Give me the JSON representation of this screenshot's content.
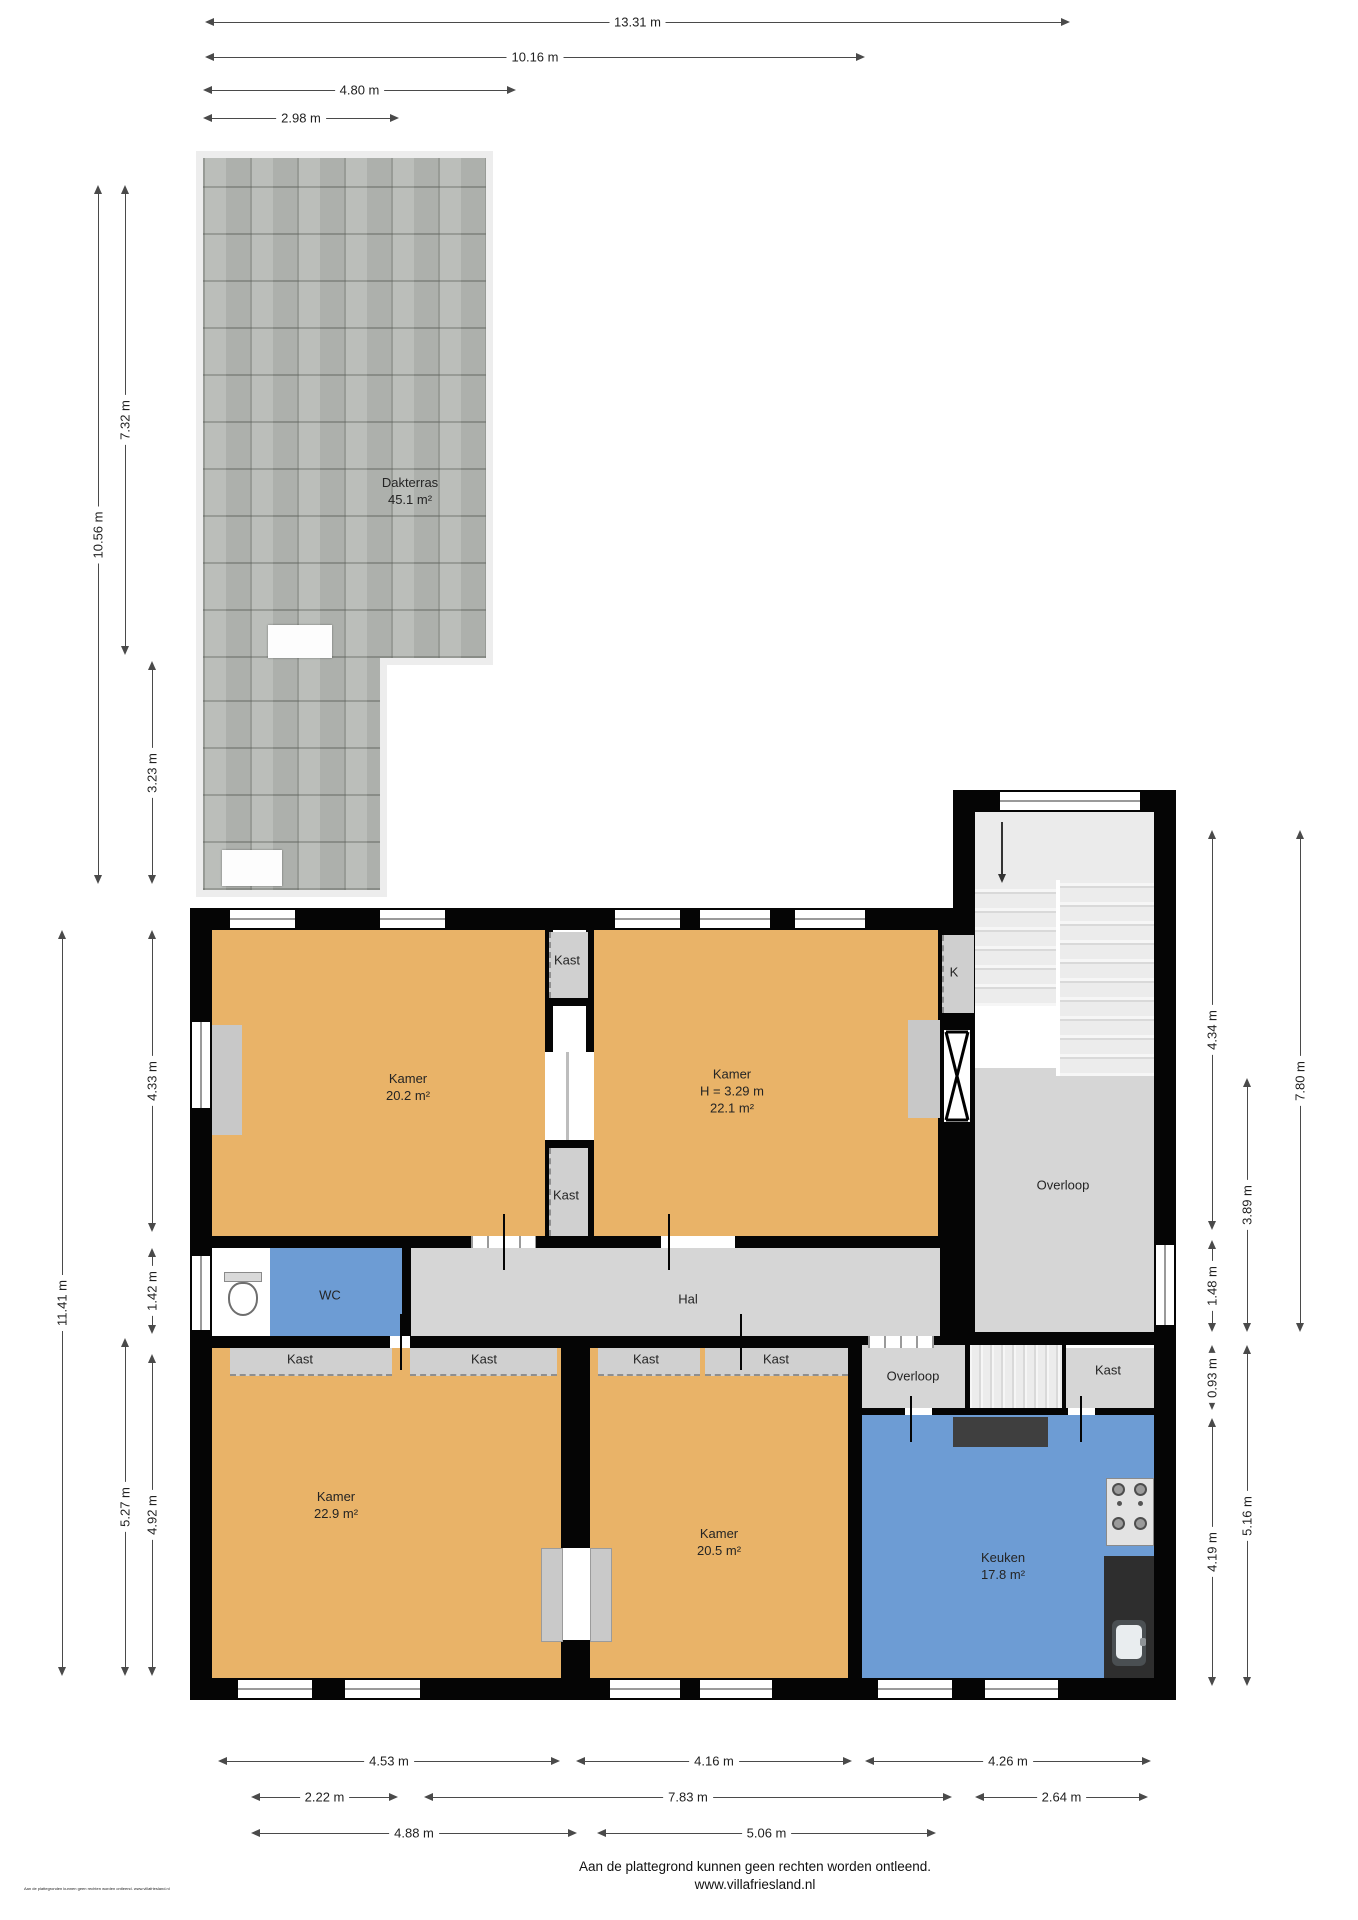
{
  "plan_title": "Plattegrond eerste verdieping",
  "colors": {
    "wall": "#050505",
    "room_orange": "#e9b368",
    "room_blue": "#6d9cd4",
    "floor_gray": "#d6d6d6",
    "terrace_tile": "#b6b9b5",
    "dimension_line": "#4a4a4a"
  },
  "rooms": [
    {
      "name": "dakterras",
      "lines": [
        "Dakterras",
        "45.1 m²"
      ],
      "x": 410,
      "y": 492
    },
    {
      "name": "kamer-20-2",
      "lines": [
        "Kamer",
        "20.2 m²"
      ],
      "x": 408,
      "y": 1088
    },
    {
      "name": "kamer-22-1",
      "lines": [
        "Kamer",
        "H = 3.29 m",
        "22.1 m²"
      ],
      "x": 732,
      "y": 1092
    },
    {
      "name": "kast-top",
      "lines": [
        "Kast"
      ],
      "x": 567,
      "y": 961
    },
    {
      "name": "kast-middle",
      "lines": [
        "Kast"
      ],
      "x": 566,
      "y": 1196
    },
    {
      "name": "kast-k",
      "lines": [
        "K"
      ],
      "x": 954,
      "y": 973
    },
    {
      "name": "overloop-boven",
      "lines": [
        "Overloop"
      ],
      "x": 1063,
      "y": 1186
    },
    {
      "name": "wc",
      "lines": [
        "WC"
      ],
      "x": 330,
      "y": 1296
    },
    {
      "name": "hal",
      "lines": [
        "Hal"
      ],
      "x": 688,
      "y": 1300
    },
    {
      "name": "kast-row-1",
      "lines": [
        "Kast"
      ],
      "x": 300,
      "y": 1360
    },
    {
      "name": "kast-row-2",
      "lines": [
        "Kast"
      ],
      "x": 484,
      "y": 1360
    },
    {
      "name": "kast-row-3",
      "lines": [
        "Kast"
      ],
      "x": 646,
      "y": 1360
    },
    {
      "name": "kast-row-4",
      "lines": [
        "Kast"
      ],
      "x": 776,
      "y": 1360
    },
    {
      "name": "overloop-onder",
      "lines": [
        "Overloop"
      ],
      "x": 913,
      "y": 1377
    },
    {
      "name": "kast-onder",
      "lines": [
        "Kast"
      ],
      "x": 1108,
      "y": 1371
    },
    {
      "name": "kamer-22-9",
      "lines": [
        "Kamer",
        "22.9 m²"
      ],
      "x": 336,
      "y": 1506
    },
    {
      "name": "kamer-20-5",
      "lines": [
        "Kamer",
        "20.5 m²"
      ],
      "x": 719,
      "y": 1543
    },
    {
      "name": "keuken",
      "lines": [
        "Keuken",
        "17.8 m²"
      ],
      "x": 1003,
      "y": 1567
    }
  ],
  "dimensions": [
    {
      "name": "dim-13-31",
      "text": "13.31 m",
      "orient": "h",
      "x1": 205,
      "x2": 1070,
      "y": 22
    },
    {
      "name": "dim-10-16",
      "text": "10.16 m",
      "orient": "h",
      "x1": 205,
      "x2": 865,
      "y": 57
    },
    {
      "name": "dim-4-80",
      "text": "4.80 m",
      "orient": "h",
      "x1": 203,
      "x2": 516,
      "y": 90
    },
    {
      "name": "dim-2-98",
      "text": "2.98 m",
      "orient": "h",
      "x1": 203,
      "x2": 399,
      "y": 118
    },
    {
      "name": "dim-10-56",
      "text": "10.56 m",
      "orient": "v",
      "x": 98,
      "y1": 185,
      "y2": 884
    },
    {
      "name": "dim-7-32",
      "text": "7.32 m",
      "orient": "v",
      "x": 125,
      "y1": 185,
      "y2": 655
    },
    {
      "name": "dim-3-23",
      "text": "3.23 m",
      "orient": "v",
      "x": 152,
      "y1": 661,
      "y2": 884
    },
    {
      "name": "dim-11-41",
      "text": "11.41 m",
      "orient": "v",
      "x": 62,
      "y1": 930,
      "y2": 1676
    },
    {
      "name": "dim-4-33",
      "text": "4.33 m",
      "orient": "v",
      "x": 152,
      "y1": 930,
      "y2": 1232
    },
    {
      "name": "dim-1-42",
      "text": "1.42 m",
      "orient": "v",
      "x": 152,
      "y1": 1248,
      "y2": 1334
    },
    {
      "name": "dim-5-27",
      "text": "5.27 m",
      "orient": "v",
      "x": 125,
      "y1": 1338,
      "y2": 1676
    },
    {
      "name": "dim-4-92",
      "text": "4.92 m",
      "orient": "v",
      "x": 152,
      "y1": 1354,
      "y2": 1676
    },
    {
      "name": "dim-4-34",
      "text": "4.34 m",
      "orient": "v",
      "x": 1212,
      "y1": 830,
      "y2": 1230
    },
    {
      "name": "dim-7-80",
      "text": "7.80 m",
      "orient": "v",
      "x": 1300,
      "y1": 830,
      "y2": 1332
    },
    {
      "name": "dim-3-89",
      "text": "3.89 m",
      "orient": "v",
      "x": 1247,
      "y1": 1078,
      "y2": 1332
    },
    {
      "name": "dim-1-48",
      "text": "1.48 m",
      "orient": "v",
      "x": 1212,
      "y1": 1240,
      "y2": 1332
    },
    {
      "name": "dim-0-93",
      "text": "0.93 m",
      "orient": "v",
      "x": 1212,
      "y1": 1345,
      "y2": 1410
    },
    {
      "name": "dim-5-16",
      "text": "5.16 m",
      "orient": "v",
      "x": 1247,
      "y1": 1345,
      "y2": 1686
    },
    {
      "name": "dim-4-19",
      "text": "4.19 m",
      "orient": "v",
      "x": 1212,
      "y1": 1418,
      "y2": 1686
    },
    {
      "name": "dim-b-4-53",
      "text": "4.53 m",
      "orient": "h",
      "x1": 218,
      "x2": 560,
      "y": 1761
    },
    {
      "name": "dim-b-4-16",
      "text": "4.16 m",
      "orient": "h",
      "x1": 576,
      "x2": 852,
      "y": 1761
    },
    {
      "name": "dim-b-4-26",
      "text": "4.26 m",
      "orient": "h",
      "x1": 865,
      "x2": 1151,
      "y": 1761
    },
    {
      "name": "dim-b-2-22",
      "text": "2.22 m",
      "orient": "h",
      "x1": 251,
      "x2": 398,
      "y": 1797
    },
    {
      "name": "dim-b-7-83",
      "text": "7.83 m",
      "orient": "h",
      "x1": 424,
      "x2": 952,
      "y": 1797
    },
    {
      "name": "dim-b-2-64",
      "text": "2.64 m",
      "orient": "h",
      "x1": 975,
      "x2": 1148,
      "y": 1797
    },
    {
      "name": "dim-b-4-88",
      "text": "4.88 m",
      "orient": "h",
      "x1": 251,
      "x2": 577,
      "y": 1833
    },
    {
      "name": "dim-b-5-06",
      "text": "5.06 m",
      "orient": "h",
      "x1": 597,
      "x2": 936,
      "y": 1833
    }
  ],
  "footer": {
    "line1": "Aan de plattegrond kunnen geen rechten worden ontleend.",
    "line2": "www.villafriesland.nl"
  },
  "fine_print": "Aan de plattegronden kunnen geen rechten worden ontleend. www.villafriesland.nl"
}
